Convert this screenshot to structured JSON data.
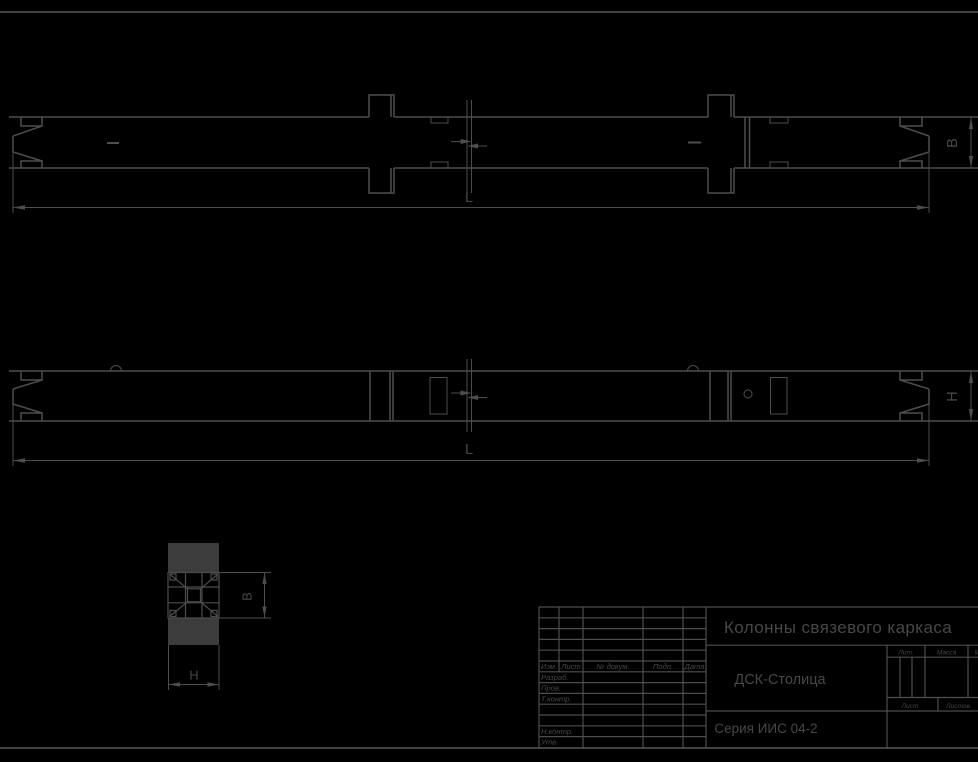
{
  "colors": {
    "background": "#000000",
    "line": "#4d4d4d",
    "text": "#474747",
    "section_fill": "#3c3c3c"
  },
  "views": {
    "top_elevation": {
      "length_dim": "L",
      "width_dim": "B"
    },
    "side_elevation": {
      "length_dim": "L",
      "height_dim": "H"
    },
    "cross_section": {
      "width_dim": "B",
      "height_dim": "H"
    }
  },
  "title_block": {
    "document_title": "Колонны связевого каркаса",
    "company": "ДСК-Столица",
    "series": "Серия ИИС 04-2",
    "revision_header": {
      "izm": "Изм.",
      "list": "Лист",
      "doc_num": "№ докум.",
      "podp": "Подп.",
      "data": "Дата"
    },
    "signatures": {
      "razrab": "Разраб.",
      "prov": "Пров.",
      "t_kontr": "Т.контр.",
      "n_kontr": "Н.контр.",
      "utv": "Утв."
    },
    "right_section": {
      "lit": "Лит.",
      "massa": "Масса",
      "masshtab": "Масштаб",
      "list": "Лист",
      "listov": "Листов"
    }
  }
}
